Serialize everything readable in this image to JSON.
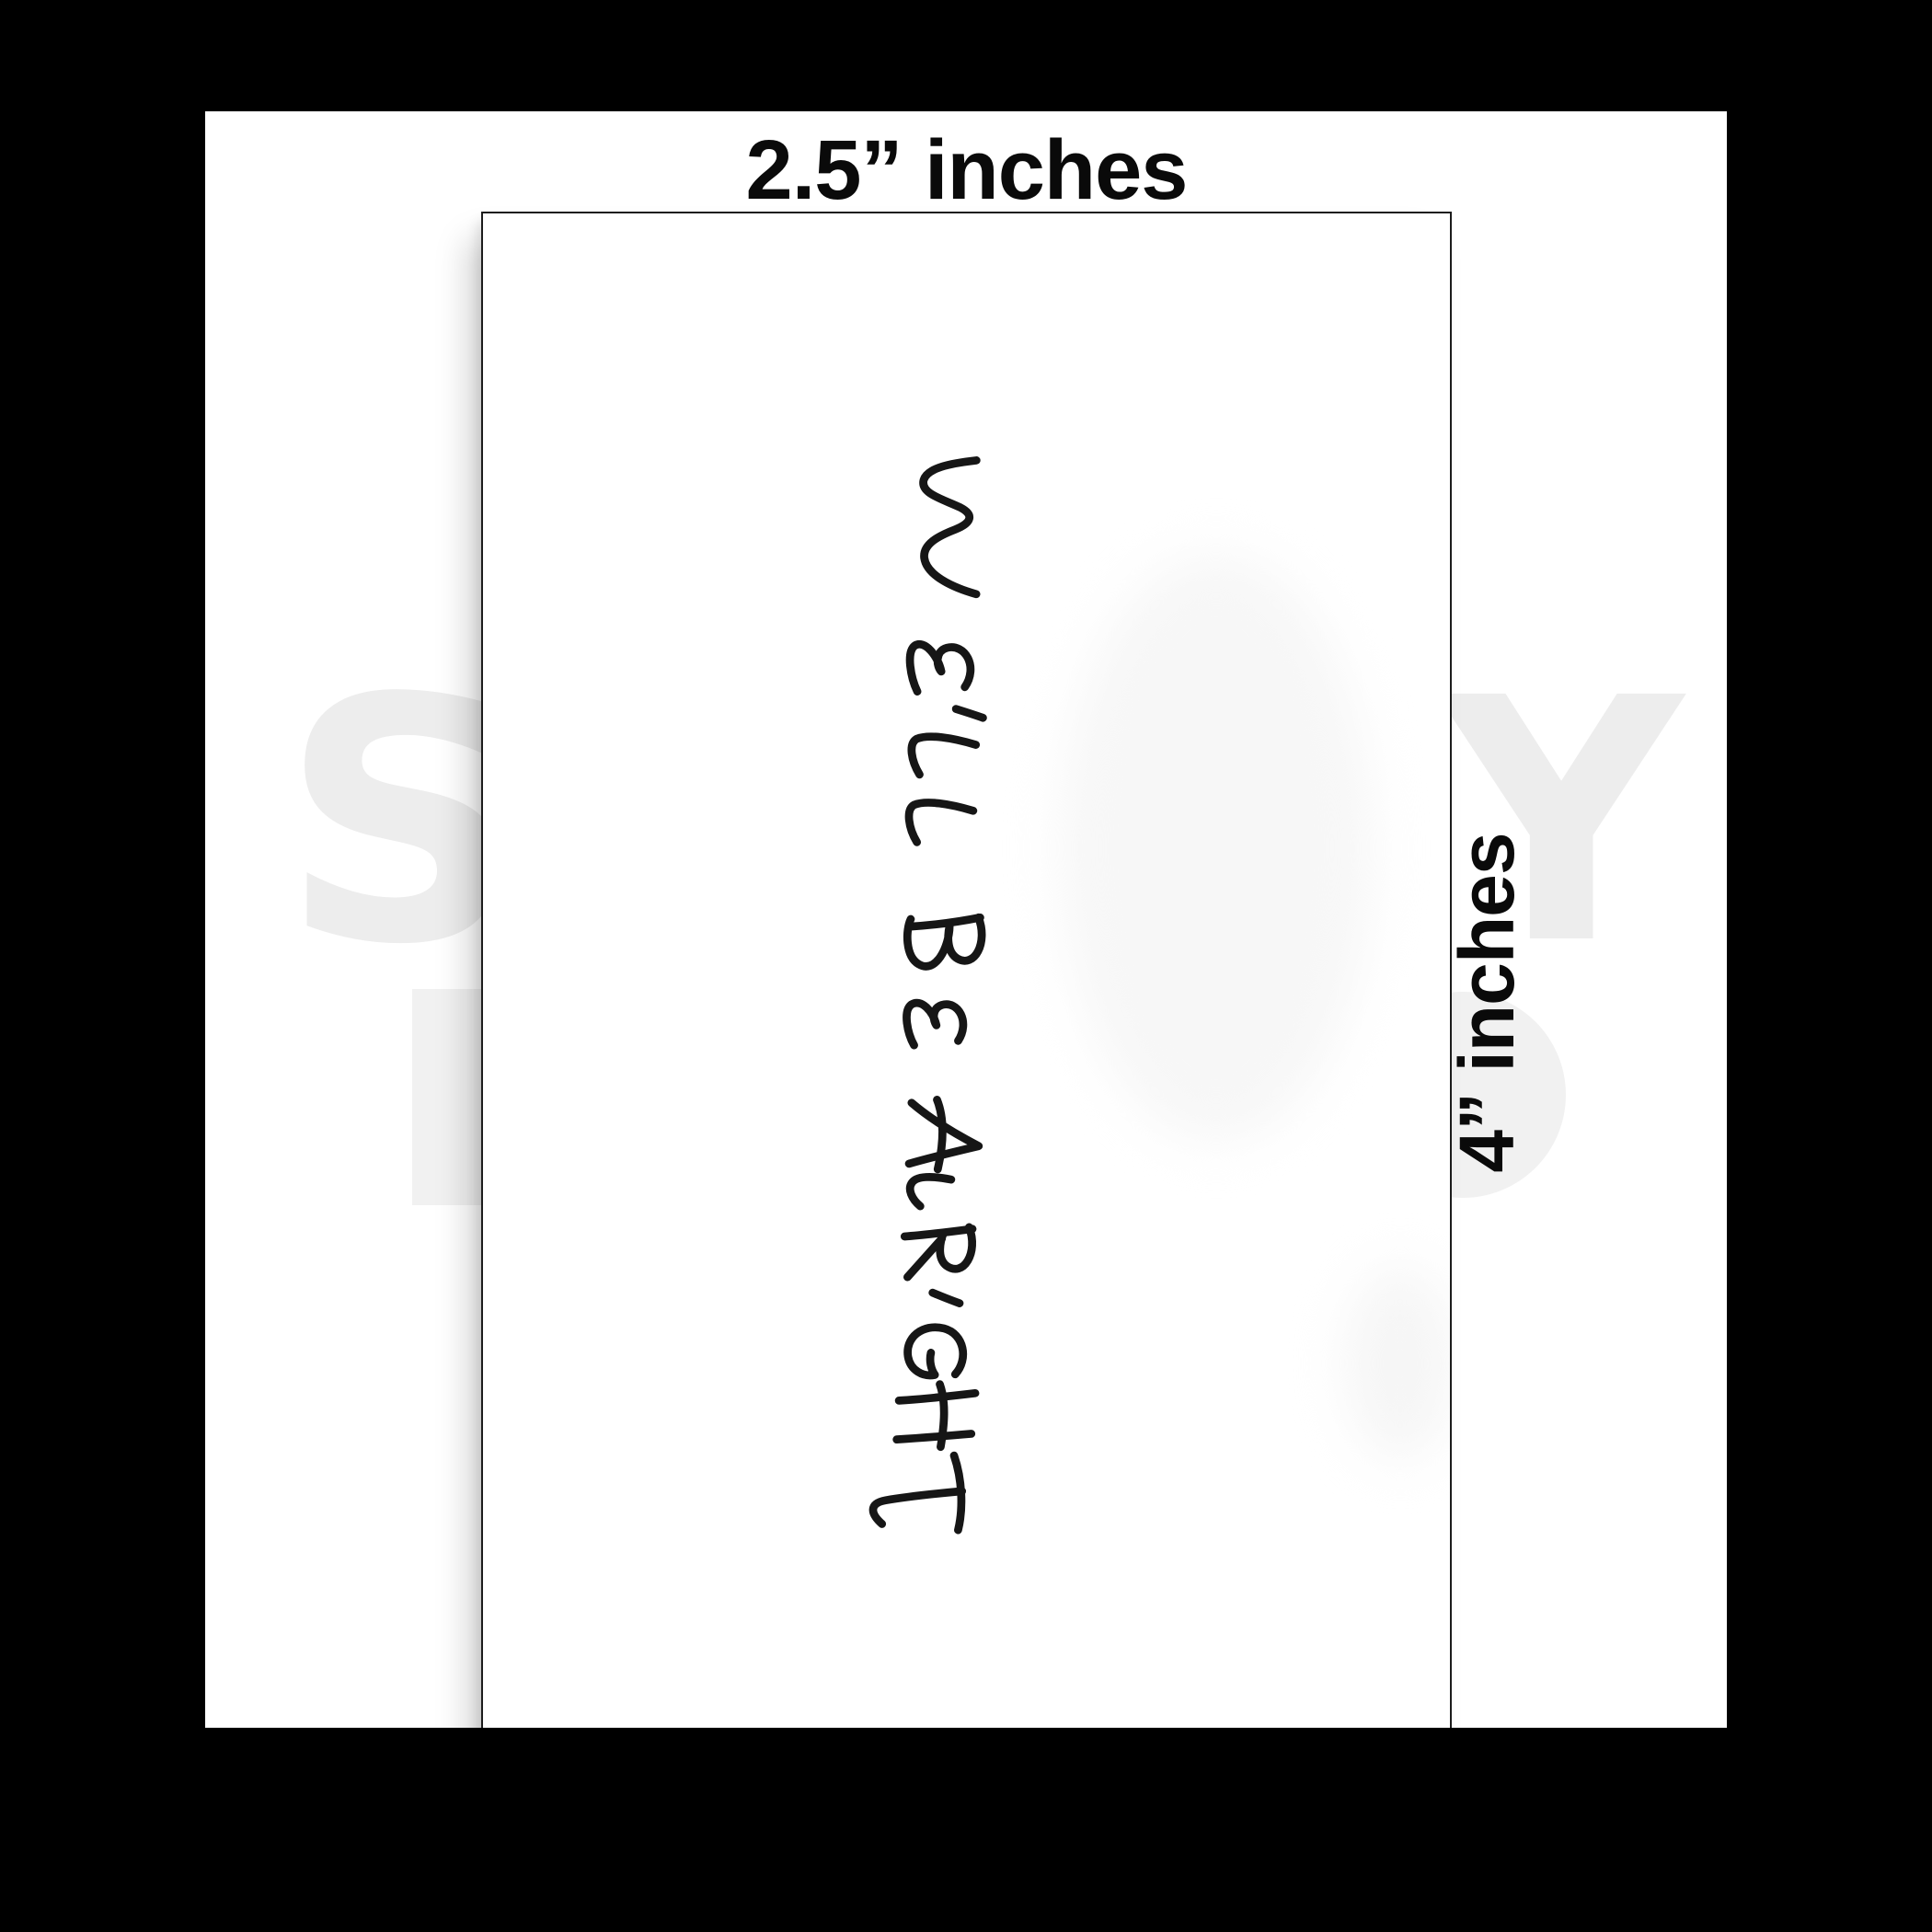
{
  "labels": {
    "top": "2.5” inches",
    "side": "4” inches"
  },
  "card": {
    "handwritten_text": "WE'LL BE ALRIGHT",
    "text_color": "#161616",
    "background_color": "#ffffff",
    "border_color": "#1c1c1c"
  },
  "watermark": {
    "left_letter": "S",
    "right_letter": "Y",
    "color": "#ededed"
  },
  "colors": {
    "frame": "#000000",
    "page_background": "#ffffff",
    "label_text": "#0a0a0a"
  }
}
